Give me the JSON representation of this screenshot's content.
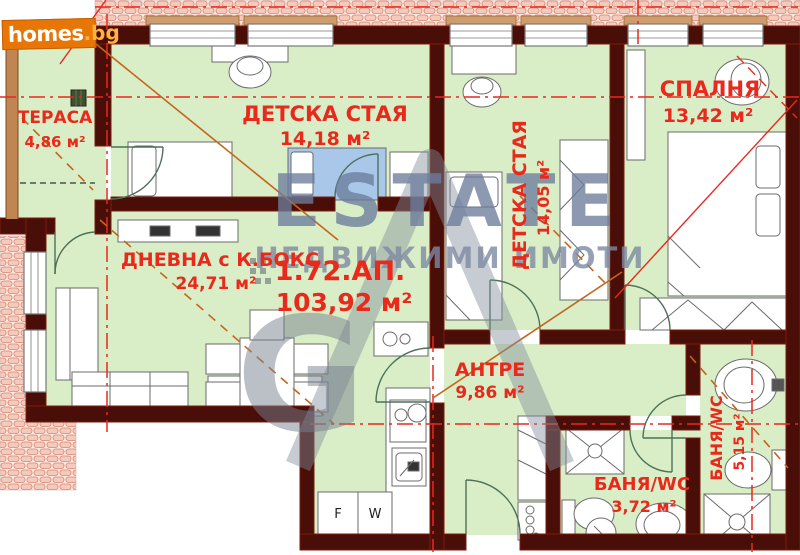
{
  "brand": {
    "name": "homes",
    "tld": ".bg"
  },
  "watermark": {
    "title": "ESTATE",
    "subtitle": "НЕДВИЖИМИ ИМОТИ",
    "monogram": "G"
  },
  "apartment": {
    "id": "1.72.АП.",
    "area": "103,92 м²"
  },
  "rooms": [
    {
      "name": "ТЕРАСА",
      "area": "4,86 м²"
    },
    {
      "name": "ДЕТСКА СТАЯ",
      "area": "14,18 м²"
    },
    {
      "name": "ДЕТСКА СТАЯ",
      "area": "14,05 м²"
    },
    {
      "name": "СПАЛНЯ",
      "area": "13,42 м²"
    },
    {
      "name": "ДНЕВНА с К.БОКС",
      "area": "24,71 м²"
    },
    {
      "name": "АНТРЕ",
      "area": "9,86 м²"
    },
    {
      "name": "БАНЯ/WC",
      "area": "5,15 м²"
    },
    {
      "name": "БАНЯ/WC",
      "area": "3,72 м²"
    }
  ],
  "appliances": {
    "fridge": "F",
    "washer": "W"
  },
  "colors": {
    "label_red": "#e8291c",
    "wall": "#4a0e08",
    "floor_green": "#d9eec6",
    "brand_orange": "#e87606",
    "watermark_blue": "#7c8aa5",
    "diagonal_orange": "#c4651c"
  }
}
